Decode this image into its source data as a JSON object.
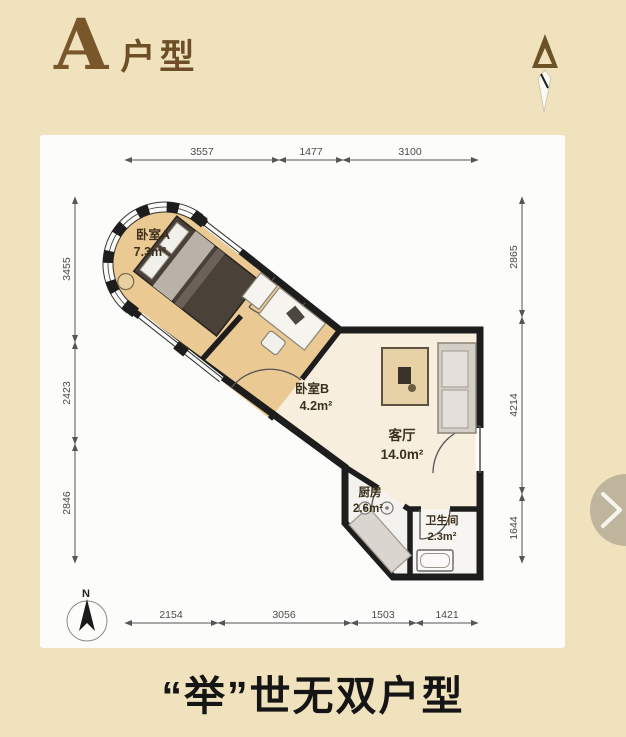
{
  "header": {
    "title_letter": "A",
    "title_suffix": "户型"
  },
  "plan": {
    "rooms": {
      "bedroomA": {
        "name": "卧室A",
        "area": "7.3m²"
      },
      "bedroomB": {
        "name": "卧室B",
        "area": "4.2m²"
      },
      "living": {
        "name": "客厅",
        "area": "14.0m²"
      },
      "kitchen": {
        "name": "厨房",
        "area": "2.6m²"
      },
      "bathroom": {
        "name": "卫生间",
        "area": "2.3m²"
      }
    },
    "dimensions": {
      "top": [
        "3557",
        "1477",
        "3100"
      ],
      "bottom": [
        "2154",
        "3056",
        "1503",
        "1421"
      ],
      "left": [
        "3455",
        "2423",
        "2846"
      ],
      "right": [
        "2865",
        "4214",
        "1644"
      ]
    },
    "compass_label": "N"
  },
  "caption": "“举”世无双户型",
  "colors": {
    "page_background": "#f0e2bd",
    "wall": "#1d1d1d",
    "bedroom_fill": "#eac992",
    "living_fill": "#f7eedd",
    "service_fill": "#f4f2ee",
    "title_brown": "#7a572a"
  }
}
